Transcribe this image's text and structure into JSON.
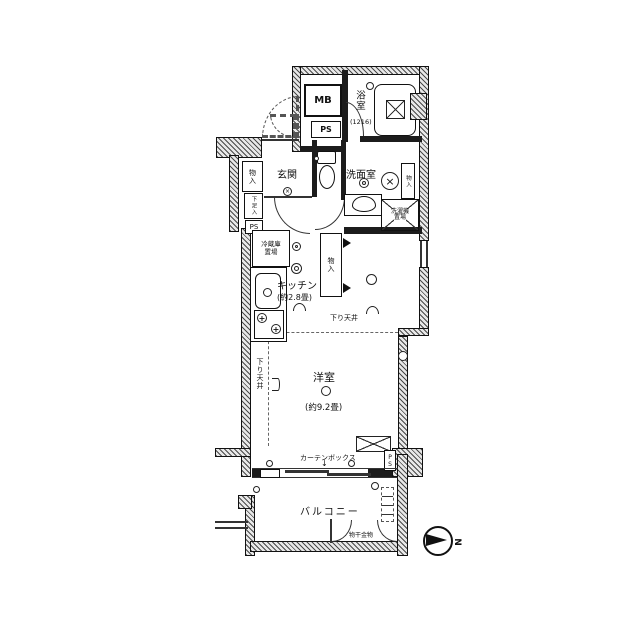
{
  "rooms": {
    "genkan": "玄関",
    "bathroom": "浴室",
    "bathroom_size": "(1216)",
    "washroom": "洗面室",
    "kitchen": "キッチン",
    "kitchen_size": "(約2.8畳)",
    "western": "洋室",
    "western_size": "(約9.2畳)",
    "balcony": "バルコニー"
  },
  "labels": {
    "mb": "MB",
    "ps_top": "PS",
    "ps_entrance": "PS",
    "ps_bottom": "PS",
    "closet_entrance": "物入",
    "shoe_cabinet": "下足入",
    "closet_hall": "物入",
    "closet_washroom": "物入",
    "fridge_line1": "冷蔵庫",
    "fridge_line2": "置場",
    "washer_line1": "洗濯機",
    "washer_line2": "置場",
    "lowered_ceiling_kitchen": "下り天井",
    "lowered_ceiling_western": "下り天井",
    "curtain_box": "カーテンボックス",
    "curtain_arrow": "↓",
    "laundry_hardware": "物干金物",
    "north": "N"
  }
}
